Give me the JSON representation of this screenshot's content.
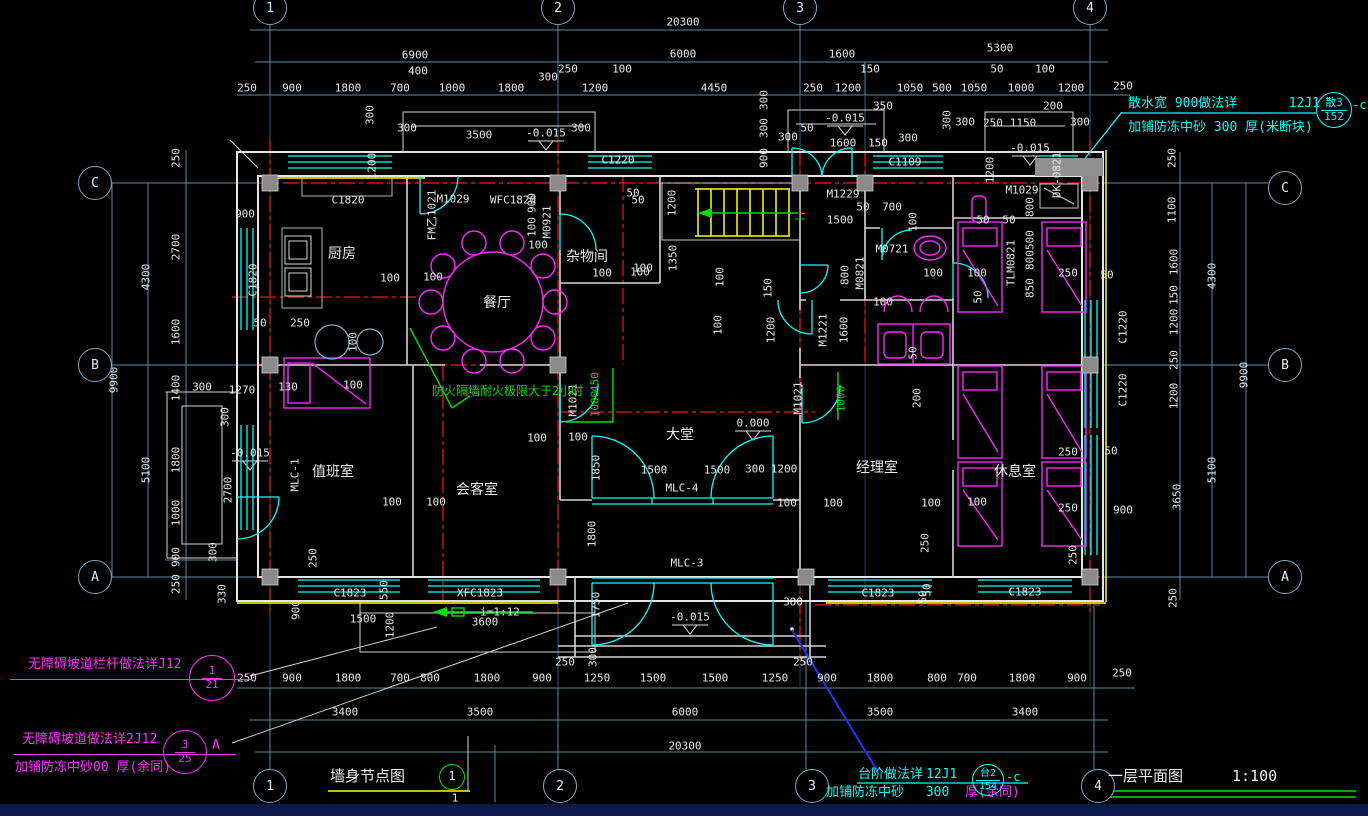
{
  "drawing": {
    "floor_plan_title": "一层平面图",
    "floor_plan_scale": "1:100",
    "wall_node_title": "墙身节点图",
    "wall_node_bubble": "1",
    "wall_node_sub": "1"
  },
  "notes": {
    "splash": {
      "line1": "散水宽  900做法详",
      "ref1": "12J1",
      "line2": "加铺防冻中砂   300  厚(米断块)",
      "bubble_top": "散3",
      "bubble_bottom": "152",
      "suffix": "-c"
    },
    "ramp_rail": {
      "line1": "无障碍坡道栏杆做法详J12",
      "bubble_top": "1",
      "bubble_bottom": "21"
    },
    "ramp": {
      "line1": "无障碍坡道做法详2J12",
      "line2": "加铺防冻中砂00  厚(余同)",
      "bubble_top": "3",
      "bubble_bottom": "25",
      "suffix": "A"
    },
    "steps": {
      "line1": "台阶做法详",
      "ref1": "12J1",
      "line2a": "加铺防冻中砂",
      "line2b": "300",
      "line2c": "厚(余同)",
      "bubble_top": "台2",
      "bubble_bottom": "154",
      "suffix": "-c"
    },
    "firewall": "防火隔墙耐火极限大于2小时"
  },
  "grid_bubbles": {
    "top": [
      {
        "label": "1",
        "x": 270
      },
      {
        "label": "2",
        "x": 558
      },
      {
        "label": "3",
        "x": 800
      },
      {
        "label": "4",
        "x": 1090
      }
    ],
    "bottom": [
      {
        "label": "1",
        "x": 270
      },
      {
        "label": "2",
        "x": 560
      },
      {
        "label": "3",
        "x": 812
      },
      {
        "label": "4",
        "x": 1098
      }
    ],
    "left": [
      {
        "label": "C",
        "y": 183
      },
      {
        "label": "B",
        "y": 365
      },
      {
        "label": "A",
        "y": 577
      }
    ],
    "right": [
      {
        "label": "C",
        "y": 188
      },
      {
        "label": "B",
        "y": 365
      },
      {
        "label": "A",
        "y": 577
      }
    ]
  },
  "labels": [
    {
      "t": "20300",
      "x": 683,
      "y": 22
    },
    {
      "t": "6900",
      "x": 415,
      "y": 55
    },
    {
      "t": "6000",
      "x": 683,
      "y": 54
    },
    {
      "t": "1600",
      "x": 842,
      "y": 54
    },
    {
      "t": "5300",
      "x": 1000,
      "y": 48
    },
    {
      "t": "400",
      "x": 418,
      "y": 71
    },
    {
      "t": "250",
      "x": 568,
      "y": 69
    },
    {
      "t": "100",
      "x": 622,
      "y": 69
    },
    {
      "t": "150",
      "x": 870,
      "y": 69
    },
    {
      "t": "50",
      "x": 997,
      "y": 69
    },
    {
      "t": "100",
      "x": 1045,
      "y": 69
    },
    {
      "t": "250",
      "x": 247,
      "y": 88
    },
    {
      "t": "900",
      "x": 292,
      "y": 88
    },
    {
      "t": "1800",
      "x": 348,
      "y": 88
    },
    {
      "t": "700",
      "x": 400,
      "y": 88
    },
    {
      "t": "1000",
      "x": 452,
      "y": 88
    },
    {
      "t": "1800",
      "x": 511,
      "y": 88
    },
    {
      "t": "300",
      "x": 548,
      "y": 77
    },
    {
      "t": "1200",
      "x": 595,
      "y": 88
    },
    {
      "t": "4450",
      "x": 714,
      "y": 88
    },
    {
      "t": "250",
      "x": 813,
      "y": 88
    },
    {
      "t": "1200",
      "x": 848,
      "y": 88
    },
    {
      "t": "1050",
      "x": 910,
      "y": 88
    },
    {
      "t": "500",
      "x": 942,
      "y": 88
    },
    {
      "t": "1050",
      "x": 974,
      "y": 88
    },
    {
      "t": "1000",
      "x": 1021,
      "y": 88
    },
    {
      "t": "1200",
      "x": 1071,
      "y": 88
    },
    {
      "t": "250",
      "x": 1123,
      "y": 86
    },
    {
      "t": "350",
      "x": 883,
      "y": 106
    },
    {
      "t": "200",
      "x": 1053,
      "y": 106
    },
    {
      "t": "300",
      "x": 370,
      "y": 115,
      "r": 1
    },
    {
      "t": "300",
      "x": 407,
      "y": 128
    },
    {
      "t": "3500",
      "x": 479,
      "y": 135
    },
    {
      "t": "-0.015",
      "x": 546,
      "y": 133
    },
    {
      "t": "300",
      "x": 581,
      "y": 128
    },
    {
      "t": "1200",
      "x": 372,
      "y": 166,
      "r": 1
    },
    {
      "t": "C1220",
      "x": 618,
      "y": 160,
      "n": "window-tag"
    },
    {
      "t": "300",
      "x": 764,
      "y": 100,
      "r": 1
    },
    {
      "t": "300",
      "x": 764,
      "y": 128,
      "r": 1
    },
    {
      "t": "900",
      "x": 764,
      "y": 158,
      "r": 1
    },
    {
      "t": "50",
      "x": 807,
      "y": 128
    },
    {
      "t": "-0.015",
      "x": 845,
      "y": 118
    },
    {
      "t": "1600",
      "x": 843,
      "y": 143
    },
    {
      "t": "150",
      "x": 878,
      "y": 143
    },
    {
      "t": "300",
      "x": 788,
      "y": 137
    },
    {
      "t": "300",
      "x": 908,
      "y": 138
    },
    {
      "t": "C1109",
      "x": 905,
      "y": 162,
      "n": "window-tag"
    },
    {
      "t": "300",
      "x": 947,
      "y": 120,
      "r": 1
    },
    {
      "t": "300",
      "x": 965,
      "y": 122
    },
    {
      "t": "250",
      "x": 993,
      "y": 123
    },
    {
      "t": "1150",
      "x": 1023,
      "y": 123
    },
    {
      "t": "300",
      "x": 1080,
      "y": 122
    },
    {
      "t": "1200",
      "x": 990,
      "y": 170,
      "r": 1
    },
    {
      "t": "-0.015",
      "x": 1030,
      "y": 148
    },
    {
      "t": "250",
      "x": 176,
      "y": 158,
      "r": 1
    },
    {
      "t": "2700",
      "x": 176,
      "y": 247,
      "r": 1
    },
    {
      "t": "1600",
      "x": 176,
      "y": 332,
      "r": 1
    },
    {
      "t": "1400",
      "x": 176,
      "y": 388,
      "r": 1
    },
    {
      "t": "1800",
      "x": 176,
      "y": 460,
      "r": 1
    },
    {
      "t": "1000",
      "x": 176,
      "y": 513,
      "r": 1
    },
    {
      "t": "900",
      "x": 176,
      "y": 557,
      "r": 1
    },
    {
      "t": "250",
      "x": 176,
      "y": 584,
      "r": 1
    },
    {
      "t": "330",
      "x": 222,
      "y": 594,
      "r": 1
    },
    {
      "t": "4300",
      "x": 146,
      "y": 277,
      "r": 1
    },
    {
      "t": "5100",
      "x": 146,
      "y": 470,
      "r": 1
    },
    {
      "t": "9900",
      "x": 114,
      "y": 380,
      "r": 1
    },
    {
      "t": "900",
      "x": 245,
      "y": 214
    },
    {
      "t": "C1820",
      "x": 348,
      "y": 200,
      "n": "window-tag"
    },
    {
      "t": "C1820",
      "x": 253,
      "y": 280,
      "r": 1,
      "n": "window-tag"
    },
    {
      "t": "50",
      "x": 260,
      "y": 323
    },
    {
      "t": "250",
      "x": 300,
      "y": 323
    },
    {
      "t": "300",
      "x": 202,
      "y": 387
    },
    {
      "t": "1270",
      "x": 242,
      "y": 390
    },
    {
      "t": "130",
      "x": 288,
      "y": 387
    },
    {
      "t": "100",
      "x": 353,
      "y": 385
    },
    {
      "t": "300",
      "x": 225,
      "y": 417,
      "r": 1
    },
    {
      "t": "-0.015",
      "x": 250,
      "y": 453
    },
    {
      "t": "2700",
      "x": 228,
      "y": 490,
      "r": 1
    },
    {
      "t": "300",
      "x": 213,
      "y": 552,
      "r": 1
    },
    {
      "t": "厨房",
      "x": 342,
      "y": 254,
      "s": 14,
      "n": "room-label-kitchen"
    },
    {
      "t": "餐厅",
      "x": 497,
      "y": 303,
      "s": 14,
      "n": "room-label-dining"
    },
    {
      "t": "杂物间",
      "x": 587,
      "y": 257,
      "s": 14,
      "n": "room-label-storage"
    },
    {
      "t": "100",
      "x": 390,
      "y": 278
    },
    {
      "t": "100",
      "x": 433,
      "y": 277
    },
    {
      "t": "100",
      "x": 538,
      "y": 245
    },
    {
      "t": "900",
      "x": 532,
      "y": 203,
      "r": 1
    },
    {
      "t": "100",
      "x": 532,
      "y": 227,
      "r": 1
    },
    {
      "t": "M1029",
      "x": 453,
      "y": 199,
      "n": "door-tag"
    },
    {
      "t": "WFC1820",
      "x": 513,
      "y": 200,
      "n": "window-tag"
    },
    {
      "t": "FM乙1021",
      "x": 432,
      "y": 215,
      "r": 1,
      "n": "door-tag"
    },
    {
      "t": "M0921",
      "x": 547,
      "y": 222,
      "r": 1,
      "n": "door-tag"
    },
    {
      "t": "50",
      "x": 633,
      "y": 193
    },
    {
      "t": "100",
      "x": 602,
      "y": 273
    },
    {
      "t": "100",
      "x": 643,
      "y": 268
    },
    {
      "t": "100",
      "x": 353,
      "y": 342,
      "r": 1
    },
    {
      "t": "1200",
      "x": 672,
      "y": 203,
      "r": 1
    },
    {
      "t": "50",
      "x": 638,
      "y": 200
    },
    {
      "t": "1350",
      "x": 673,
      "y": 258,
      "r": 1
    },
    {
      "t": "100",
      "x": 640,
      "y": 272
    },
    {
      "t": "100",
      "x": 718,
      "y": 325,
      "r": 1
    },
    {
      "t": "100",
      "x": 720,
      "y": 277,
      "r": 1
    },
    {
      "t": "M1229",
      "x": 843,
      "y": 194,
      "n": "door-tag"
    },
    {
      "t": "1500",
      "x": 840,
      "y": 220
    },
    {
      "t": "50",
      "x": 863,
      "y": 207
    },
    {
      "t": "700",
      "x": 892,
      "y": 207
    },
    {
      "t": "100",
      "x": 913,
      "y": 222,
      "r": 1
    },
    {
      "t": "M0721",
      "x": 892,
      "y": 249,
      "n": "door-tag"
    },
    {
      "t": "M0821",
      "x": 860,
      "y": 273,
      "r": 1,
      "n": "door-tag"
    },
    {
      "t": "800",
      "x": 845,
      "y": 275,
      "r": 1
    },
    {
      "t": "100",
      "x": 933,
      "y": 273
    },
    {
      "t": "100",
      "x": 977,
      "y": 273
    },
    {
      "t": "100",
      "x": 883,
      "y": 302
    },
    {
      "t": "50",
      "x": 913,
      "y": 353,
      "r": 1
    },
    {
      "t": "M1221",
      "x": 823,
      "y": 330,
      "r": 1,
      "n": "door-tag"
    },
    {
      "t": "1600",
      "x": 844,
      "y": 330,
      "r": 1
    },
    {
      "t": "150",
      "x": 768,
      "y": 288,
      "r": 1
    },
    {
      "t": "1200",
      "x": 771,
      "y": 330,
      "r": 1
    },
    {
      "t": "50",
      "x": 983,
      "y": 220
    },
    {
      "t": "50",
      "x": 1009,
      "y": 220
    },
    {
      "t": "50",
      "x": 978,
      "y": 297,
      "r": 1
    },
    {
      "t": "上",
      "x": 800,
      "y": 215,
      "c": "g",
      "s": 12
    },
    {
      "t": "M1029",
      "x": 1022,
      "y": 190,
      "n": "door-tag"
    },
    {
      "t": "DK-0821",
      "x": 1057,
      "y": 175,
      "r": 1,
      "n": "door-tag"
    },
    {
      "t": "TLM0821",
      "x": 1011,
      "y": 263,
      "r": 1,
      "n": "door-tag"
    },
    {
      "t": "800",
      "x": 1030,
      "y": 207,
      "r": 1
    },
    {
      "t": "500",
      "x": 1030,
      "y": 240,
      "r": 1
    },
    {
      "t": "800",
      "x": 1030,
      "y": 260,
      "r": 1
    },
    {
      "t": "850",
      "x": 1030,
      "y": 288,
      "r": 1
    },
    {
      "t": "250",
      "x": 1068,
      "y": 273
    },
    {
      "t": "50",
      "x": 1107,
      "y": 275
    },
    {
      "t": "C1220",
      "x": 1123,
      "y": 327,
      "r": 1,
      "n": "window-tag"
    },
    {
      "t": "C1220",
      "x": 1123,
      "y": 390,
      "r": 1,
      "n": "window-tag"
    },
    {
      "t": "休息室",
      "x": 1015,
      "y": 472,
      "s": 14,
      "n": "room-label-lounge"
    },
    {
      "t": "100",
      "x": 977,
      "y": 502
    },
    {
      "t": "250",
      "x": 1068,
      "y": 452
    },
    {
      "t": "250",
      "x": 1068,
      "y": 508
    },
    {
      "t": "50",
      "x": 1111,
      "y": 451
    },
    {
      "t": "900",
      "x": 1123,
      "y": 510
    },
    {
      "t": "250",
      "x": 1073,
      "y": 555,
      "r": 1
    },
    {
      "t": "250",
      "x": 1172,
      "y": 158,
      "r": 1
    },
    {
      "t": "1100",
      "x": 1172,
      "y": 210,
      "r": 1
    },
    {
      "t": "1600",
      "x": 1174,
      "y": 262,
      "r": 1
    },
    {
      "t": "150",
      "x": 1174,
      "y": 295,
      "r": 1
    },
    {
      "t": "1200",
      "x": 1174,
      "y": 322,
      "r": 1
    },
    {
      "t": "250",
      "x": 1174,
      "y": 360,
      "r": 1
    },
    {
      "t": "1200",
      "x": 1174,
      "y": 396,
      "r": 1
    },
    {
      "t": "3650",
      "x": 1177,
      "y": 497,
      "r": 1
    },
    {
      "t": "250",
      "x": 1173,
      "y": 598,
      "r": 1
    },
    {
      "t": "4300",
      "x": 1212,
      "y": 276,
      "r": 1
    },
    {
      "t": "5100",
      "x": 1212,
      "y": 470,
      "r": 1
    },
    {
      "t": "9900",
      "x": 1244,
      "y": 375,
      "r": 1
    },
    {
      "t": "值班室",
      "x": 333,
      "y": 472,
      "s": 14,
      "n": "room-label-duty"
    },
    {
      "t": "MLC-1",
      "x": 295,
      "y": 475,
      "r": 1,
      "n": "window-tag"
    },
    {
      "t": "会客室",
      "x": 477,
      "y": 490,
      "s": 14,
      "n": "room-label-reception"
    },
    {
      "t": "100",
      "x": 392,
      "y": 502
    },
    {
      "t": "100",
      "x": 436,
      "y": 502
    },
    {
      "t": "100",
      "x": 537,
      "y": 438
    },
    {
      "t": "100",
      "x": 578,
      "y": 437
    },
    {
      "t": "1850",
      "x": 596,
      "y": 468,
      "r": 1
    },
    {
      "t": "1800",
      "x": 592,
      "y": 534,
      "r": 1
    },
    {
      "t": "M1021",
      "x": 573,
      "y": 400,
      "r": 1,
      "n": "door-tag"
    },
    {
      "t": "M1021",
      "x": 798,
      "y": 398,
      "r": 1,
      "n": "door-tag"
    },
    {
      "t": "450",
      "x": 595,
      "y": 382,
      "r": 1,
      "c": "g"
    },
    {
      "t": "1000",
      "x": 595,
      "y": 404,
      "r": 1,
      "c": "g"
    },
    {
      "t": "1000",
      "x": 841,
      "y": 399,
      "r": 1,
      "c": "g"
    },
    {
      "t": "200",
      "x": 917,
      "y": 398,
      "r": 1
    },
    {
      "t": "0.000",
      "x": 753,
      "y": 423
    },
    {
      "t": "大堂",
      "x": 680,
      "y": 435,
      "s": 14,
      "n": "room-label-lobby"
    },
    {
      "t": "1500",
      "x": 654,
      "y": 470
    },
    {
      "t": "1500",
      "x": 717,
      "y": 470
    },
    {
      "t": "300",
      "x": 755,
      "y": 469
    },
    {
      "t": "1200",
      "x": 784,
      "y": 469
    },
    {
      "t": "MLC-4",
      "x": 682,
      "y": 488,
      "n": "window-tag"
    },
    {
      "t": "100",
      "x": 787,
      "y": 503
    },
    {
      "t": "100",
      "x": 833,
      "y": 503
    },
    {
      "t": "100",
      "x": 931,
      "y": 503
    },
    {
      "t": "MLC-3",
      "x": 687,
      "y": 563,
      "n": "window-tag"
    },
    {
      "t": "经理室",
      "x": 877,
      "y": 468,
      "s": 14,
      "n": "room-label-manager"
    },
    {
      "t": "250",
      "x": 925,
      "y": 543,
      "r": 1
    },
    {
      "t": "50",
      "x": 927,
      "y": 590,
      "r": 1
    },
    {
      "t": "250",
      "x": 313,
      "y": 558,
      "r": 1
    },
    {
      "t": "900",
      "x": 296,
      "y": 610,
      "r": 1
    },
    {
      "t": "C1823",
      "x": 350,
      "y": 593,
      "n": "window-tag"
    },
    {
      "t": "XFC1823",
      "x": 480,
      "y": 593,
      "n": "window-tag"
    },
    {
      "t": "1500",
      "x": 363,
      "y": 619
    },
    {
      "t": "550",
      "x": 384,
      "y": 590,
      "r": 1
    },
    {
      "t": "1200",
      "x": 390,
      "y": 625,
      "r": 1
    },
    {
      "t": "3600",
      "x": 485,
      "y": 622
    },
    {
      "t": "i=1:12",
      "x": 500,
      "y": 612
    },
    {
      "t": "1750",
      "x": 596,
      "y": 605,
      "r": 1
    },
    {
      "t": "-0.015",
      "x": 690,
      "y": 617
    },
    {
      "t": "300",
      "x": 593,
      "y": 657,
      "r": 1
    },
    {
      "t": "250",
      "x": 565,
      "y": 662
    },
    {
      "t": "250",
      "x": 803,
      "y": 662
    },
    {
      "t": "300",
      "x": 793,
      "y": 602
    },
    {
      "t": "C1823",
      "x": 878,
      "y": 593,
      "n": "window-tag"
    },
    {
      "t": "50",
      "x": 923,
      "y": 597,
      "r": 1
    },
    {
      "t": "C1823",
      "x": 1025,
      "y": 592,
      "n": "window-tag"
    },
    {
      "t": "250",
      "x": 247,
      "y": 678
    },
    {
      "t": "900",
      "x": 292,
      "y": 678
    },
    {
      "t": "1800",
      "x": 348,
      "y": 678
    },
    {
      "t": "700",
      "x": 400,
      "y": 678
    },
    {
      "t": "800",
      "x": 430,
      "y": 678
    },
    {
      "t": "1800",
      "x": 487,
      "y": 678
    },
    {
      "t": "900",
      "x": 542,
      "y": 678
    },
    {
      "t": "1250",
      "x": 597,
      "y": 678
    },
    {
      "t": "1500",
      "x": 653,
      "y": 678
    },
    {
      "t": "1500",
      "x": 715,
      "y": 678
    },
    {
      "t": "1250",
      "x": 775,
      "y": 678
    },
    {
      "t": "900",
      "x": 827,
      "y": 678
    },
    {
      "t": "1800",
      "x": 880,
      "y": 678
    },
    {
      "t": "800",
      "x": 937,
      "y": 678
    },
    {
      "t": "700",
      "x": 967,
      "y": 678
    },
    {
      "t": "1800",
      "x": 1022,
      "y": 678
    },
    {
      "t": "900",
      "x": 1077,
      "y": 678
    },
    {
      "t": "250",
      "x": 1122,
      "y": 673
    },
    {
      "t": "3400",
      "x": 345,
      "y": 712
    },
    {
      "t": "3500",
      "x": 480,
      "y": 712
    },
    {
      "t": "6000",
      "x": 685,
      "y": 712
    },
    {
      "t": "3500",
      "x": 880,
      "y": 712
    },
    {
      "t": "3400",
      "x": 1025,
      "y": 712
    },
    {
      "t": "20300",
      "x": 685,
      "y": 746
    },
    {
      "t": "1",
      "x": 455,
      "y": 798
    }
  ]
}
